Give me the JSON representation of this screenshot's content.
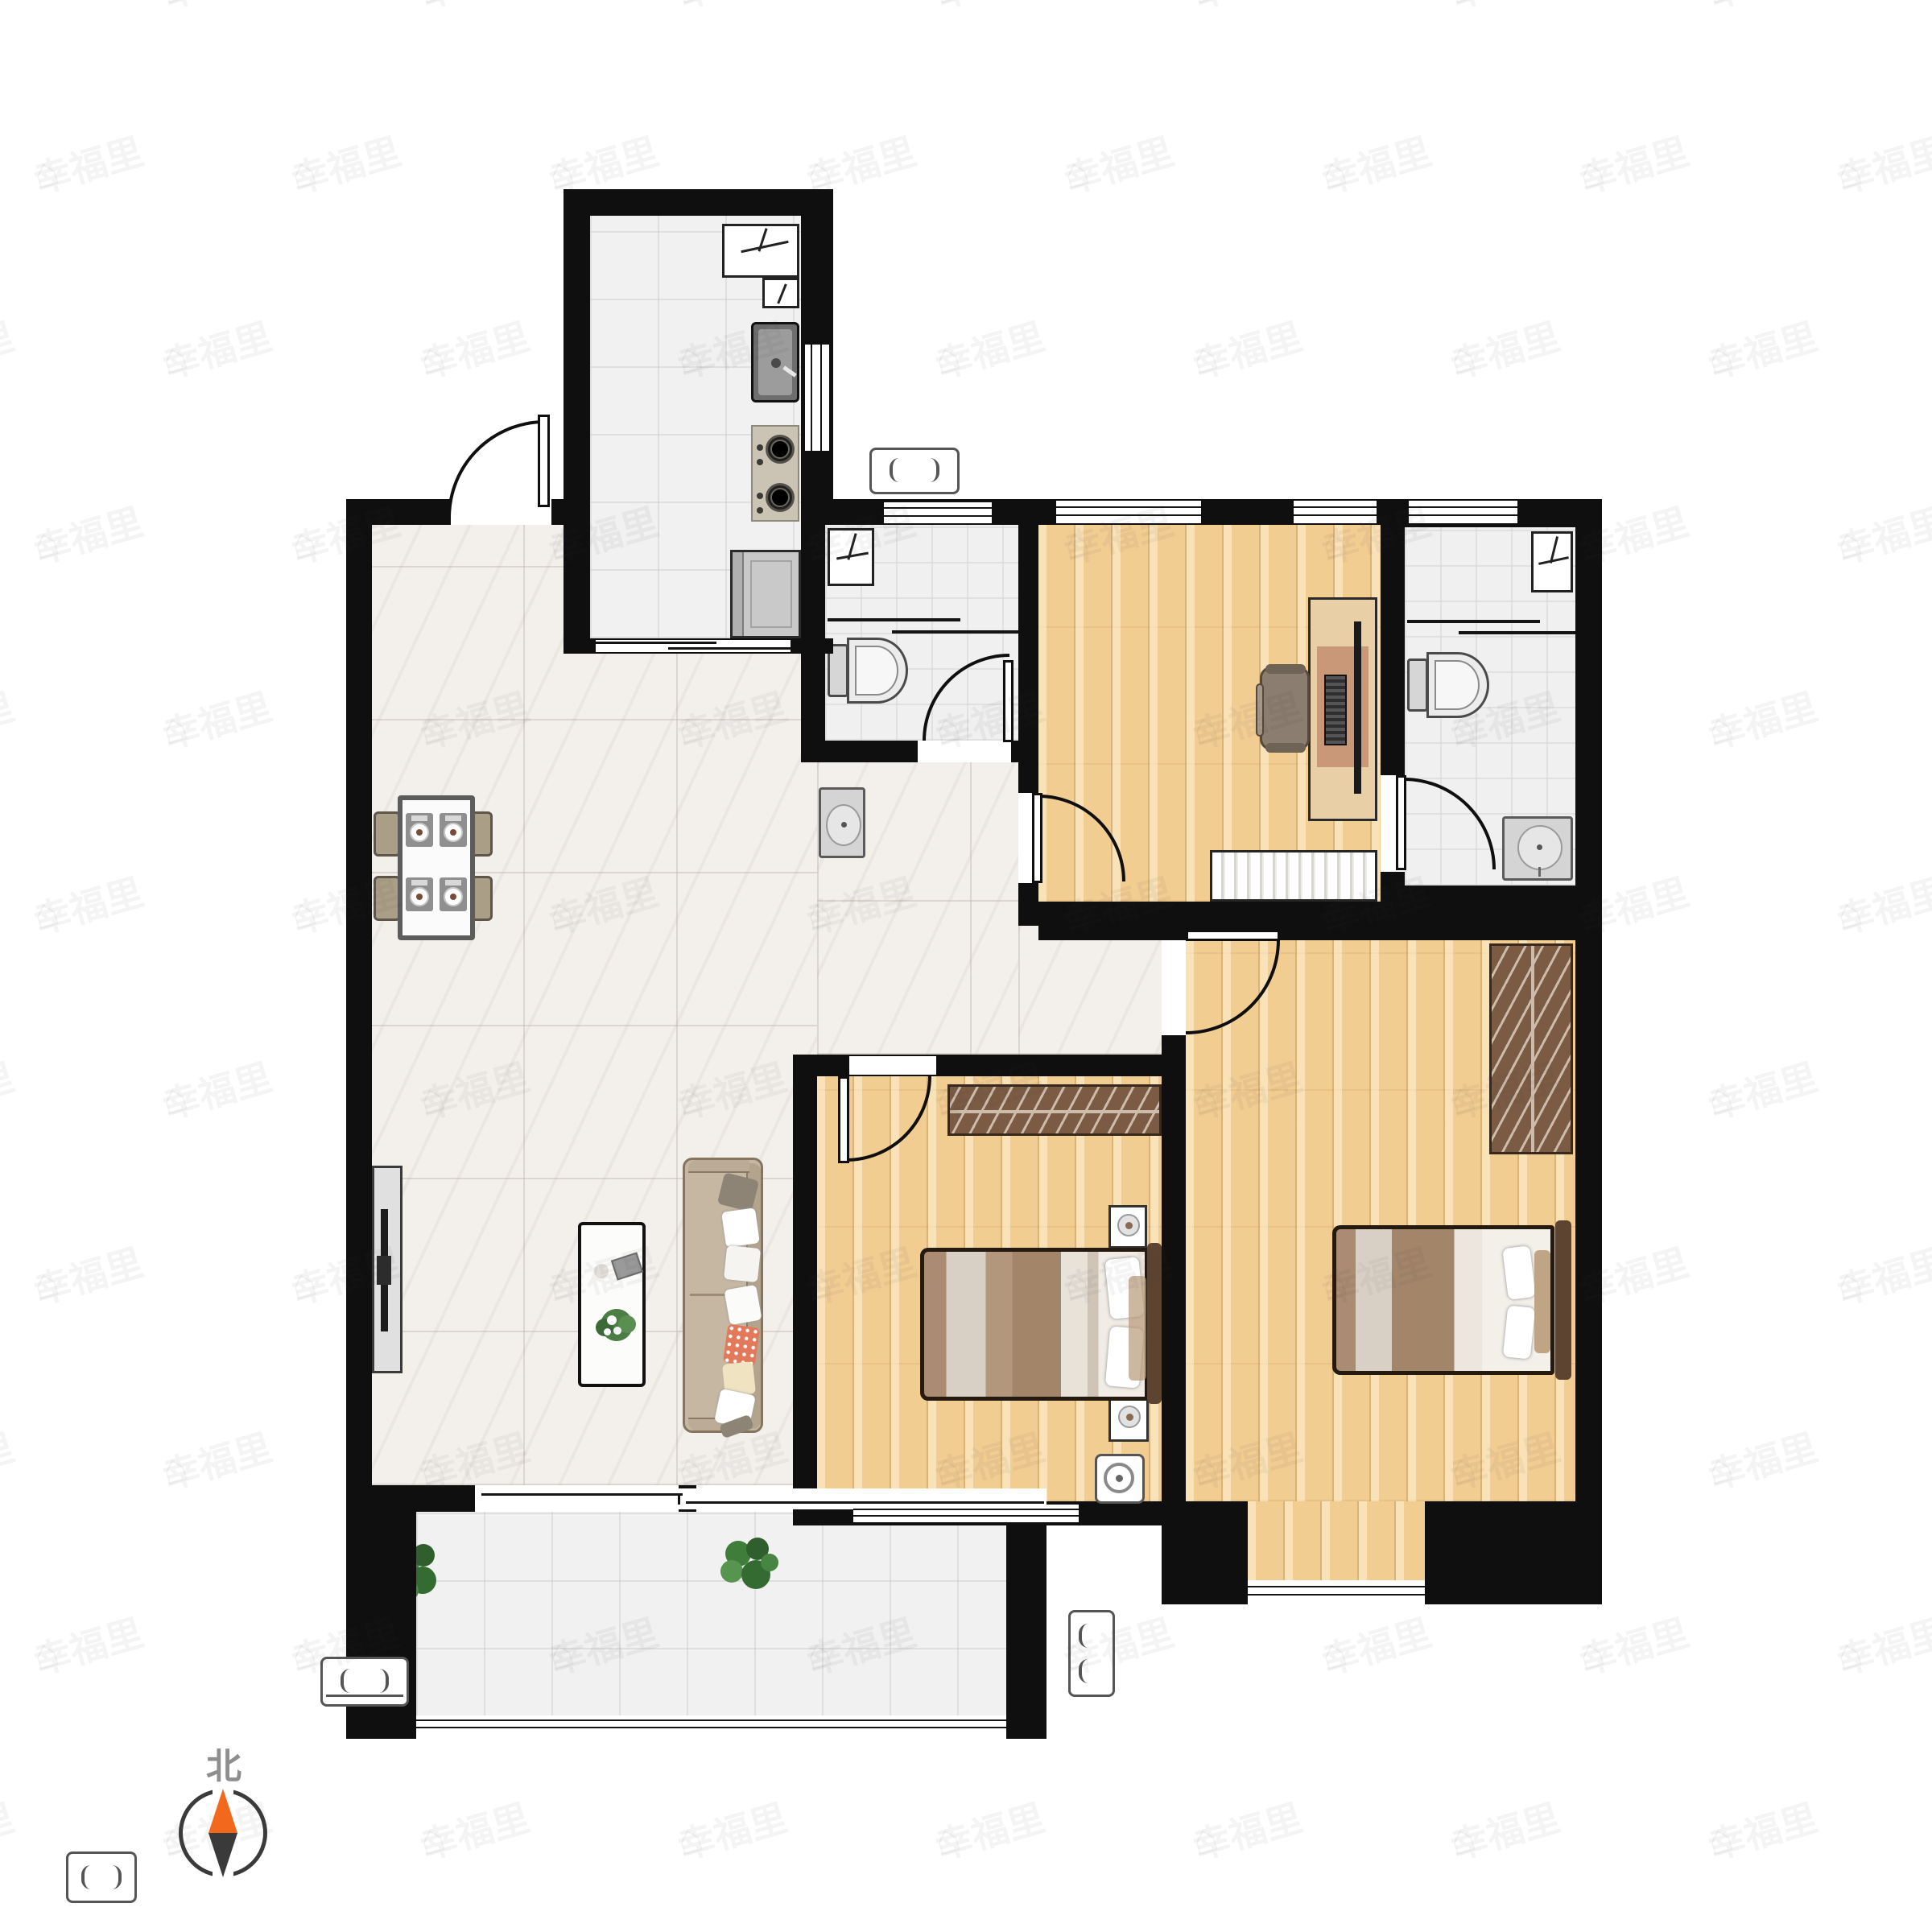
{
  "compass": {
    "label": "北",
    "icon": "compass-icon",
    "north_color": "#f2691d",
    "south_color": "#3a3a3a"
  },
  "watermark": {
    "text": "幸福里",
    "icon": "house-icon"
  },
  "colors": {
    "wall": "#0f0f0f",
    "wood_floor": "#f2cd92",
    "marble_floor": "#f3f0ec",
    "tile_floor": "#f1f1f1",
    "wardrobe_brown": "#7b5b44",
    "sofa_tan": "#c6b7a3",
    "accent_orange": "#f2691d"
  }
}
